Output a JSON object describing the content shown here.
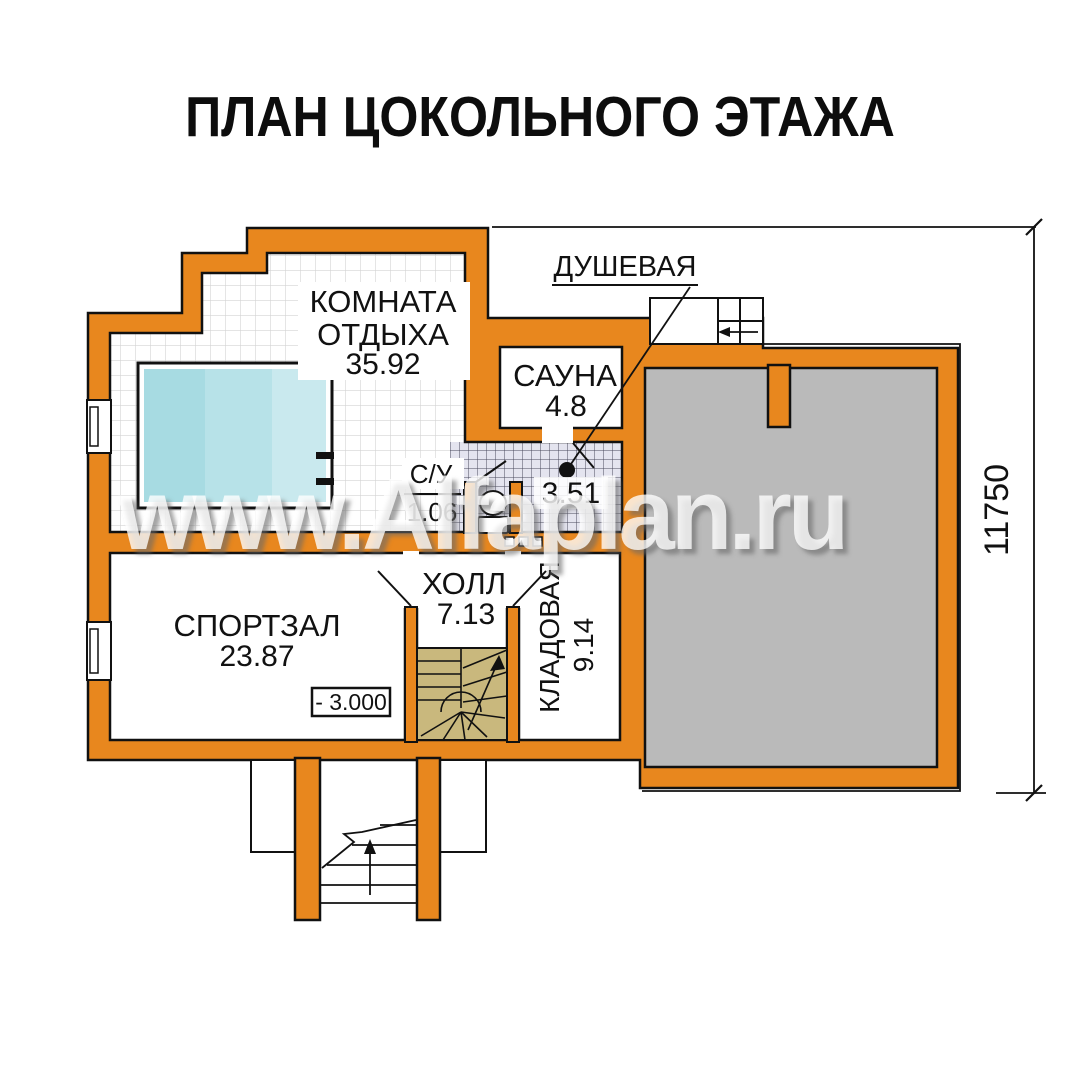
{
  "title": "ПЛАН ЦОКОЛЬНОГО ЭТАЖА",
  "watermark": "www.Alfaplan.ru",
  "dimension_right": "11750",
  "elevation": "- 3.000",
  "rooms": {
    "rest": {
      "line1": "КОМНАТА",
      "line2": "ОТДЫХА",
      "area": "35.92"
    },
    "sauna": {
      "name": "САУНА",
      "area": "4.8"
    },
    "shower": {
      "name": "ДУШЕВАЯ",
      "area": "3.51"
    },
    "wc": {
      "name": "С/У",
      "area": "1.06"
    },
    "hall": {
      "name": "ХОЛЛ",
      "area": "7.13"
    },
    "gym": {
      "name": "СПОРТЗАЛ",
      "area": "23.87"
    },
    "storage": {
      "name": "КЛАДОВАЯ",
      "area": "9.14"
    }
  },
  "colors": {
    "wall": "#E8871E",
    "outline": "#111111",
    "pool_band_1": "#A7DBE2",
    "pool_band_2": "#B7E2E8",
    "pool_band_3": "#C9E9EE",
    "garage_fill": "#BABABA",
    "stair_fill": "#C9B87D",
    "shower_tile": "#E4E4EF",
    "watermarked_text": "#8C8C8C"
  }
}
